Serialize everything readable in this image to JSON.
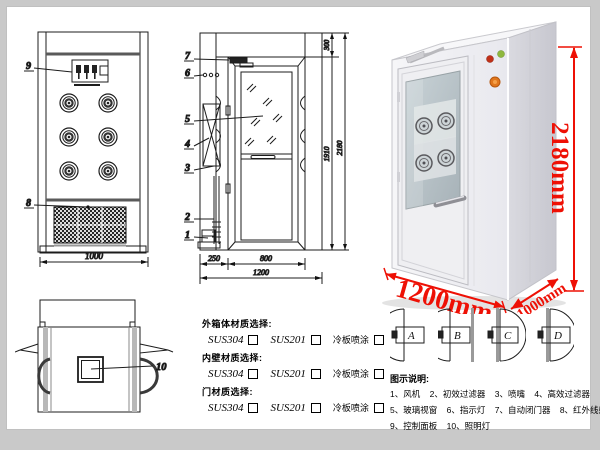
{
  "front_view": {
    "callout_9": "9",
    "callout_8": "8",
    "dim_width": "1000"
  },
  "side_view": {
    "callout_7": "7",
    "callout_6": "6",
    "callout_5": "5",
    "callout_4": "4",
    "callout_3": "3",
    "callout_2": "2",
    "callout_1": "1",
    "dim_300": "300",
    "dim_1910": "1910",
    "dim_2180": "2180",
    "dim_250": "250",
    "dim_800": "800",
    "dim_1200": "1200"
  },
  "top_view": {
    "callout_10": "10"
  },
  "photo": {
    "height_label": "2180mm",
    "width_label": "1200mm",
    "depth_label": "1000mm"
  },
  "materials": {
    "rows": [
      {
        "title": "外箱体材质选择:",
        "opt1": "SUS304",
        "opt2": "SUS201",
        "opt3": "冷板喷涂"
      },
      {
        "title": "内壁材质选择:",
        "opt1": "SUS304",
        "opt2": "SUS201",
        "opt3": "冷板喷涂"
      },
      {
        "title": "门材质选择:",
        "opt1": "SUS304",
        "opt2": "SUS201",
        "opt3": "冷板喷涂"
      }
    ]
  },
  "door_types": {
    "a": "A",
    "b": "B",
    "c": "C",
    "d": "D"
  },
  "legend": {
    "title": "图示说明:",
    "line1": [
      "1、风机",
      "2、初效过滤器",
      "3、喷嘴",
      "4、高效过滤器"
    ],
    "line2": [
      "5、玻璃视窗",
      "6、指示灯",
      "7、自动闭门器",
      "8、红外线感应器"
    ],
    "line3": [
      "9、控制面板",
      "10、照明灯"
    ]
  },
  "colors": {
    "annotation_red": "#ee1005",
    "line": "#1c1c1c"
  }
}
